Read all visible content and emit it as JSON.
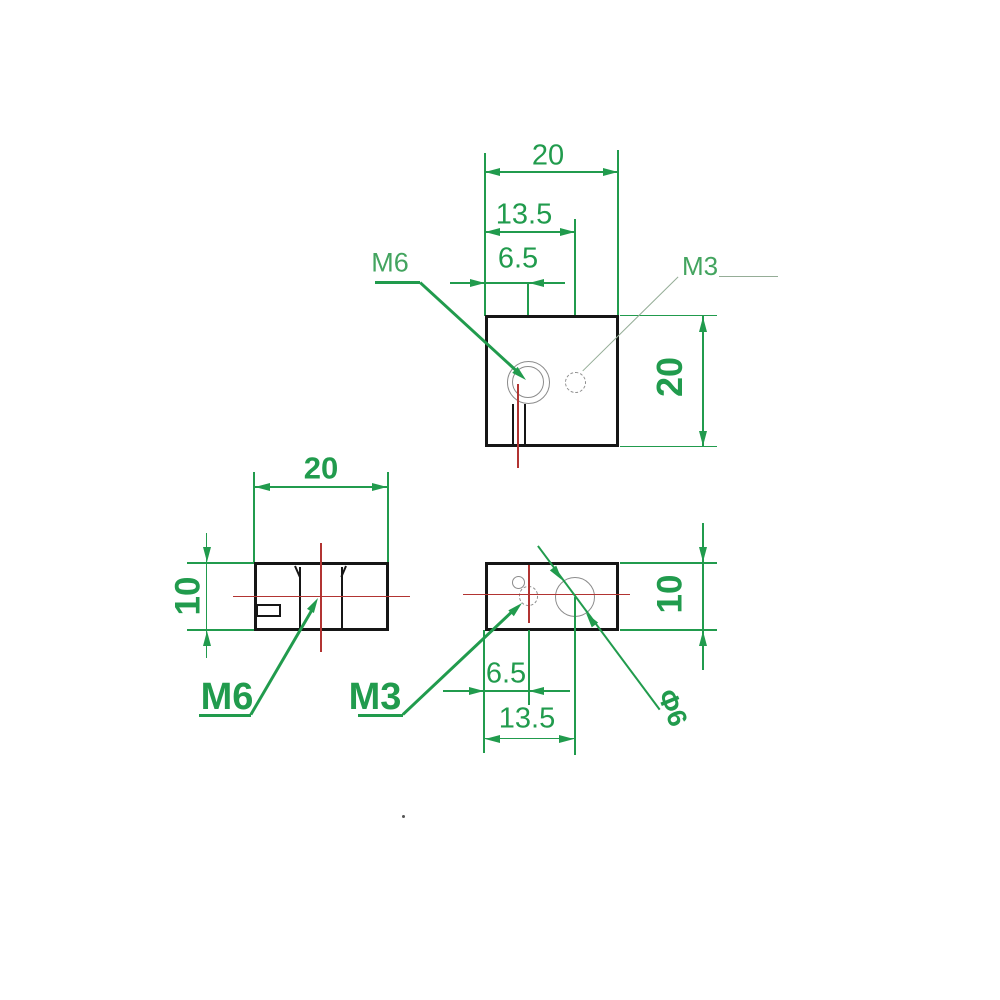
{
  "colors": {
    "dimension_green": "#219b4d",
    "label_green_light": "#43a45f",
    "centerline_red": "#b23432",
    "hole_gray": "#8c8c8c",
    "outline_black": "#161616",
    "leader_gray_green": "#95ad97"
  },
  "top_view": {
    "width_dim": "20",
    "m3_offset_dim": "13.5",
    "m6_offset_dim": "6.5",
    "height_dim": "20",
    "m6_label": "M6",
    "m3_label": "M3"
  },
  "side_view": {
    "width_dim": "20",
    "height_dim": "10",
    "m6_label": "M6"
  },
  "front_view": {
    "height_dim": "10",
    "m3_offset_dim": "6.5",
    "hole_offset_dim": "13.5",
    "m3_label": "M3",
    "hole_diameter_label": "Φ6"
  }
}
